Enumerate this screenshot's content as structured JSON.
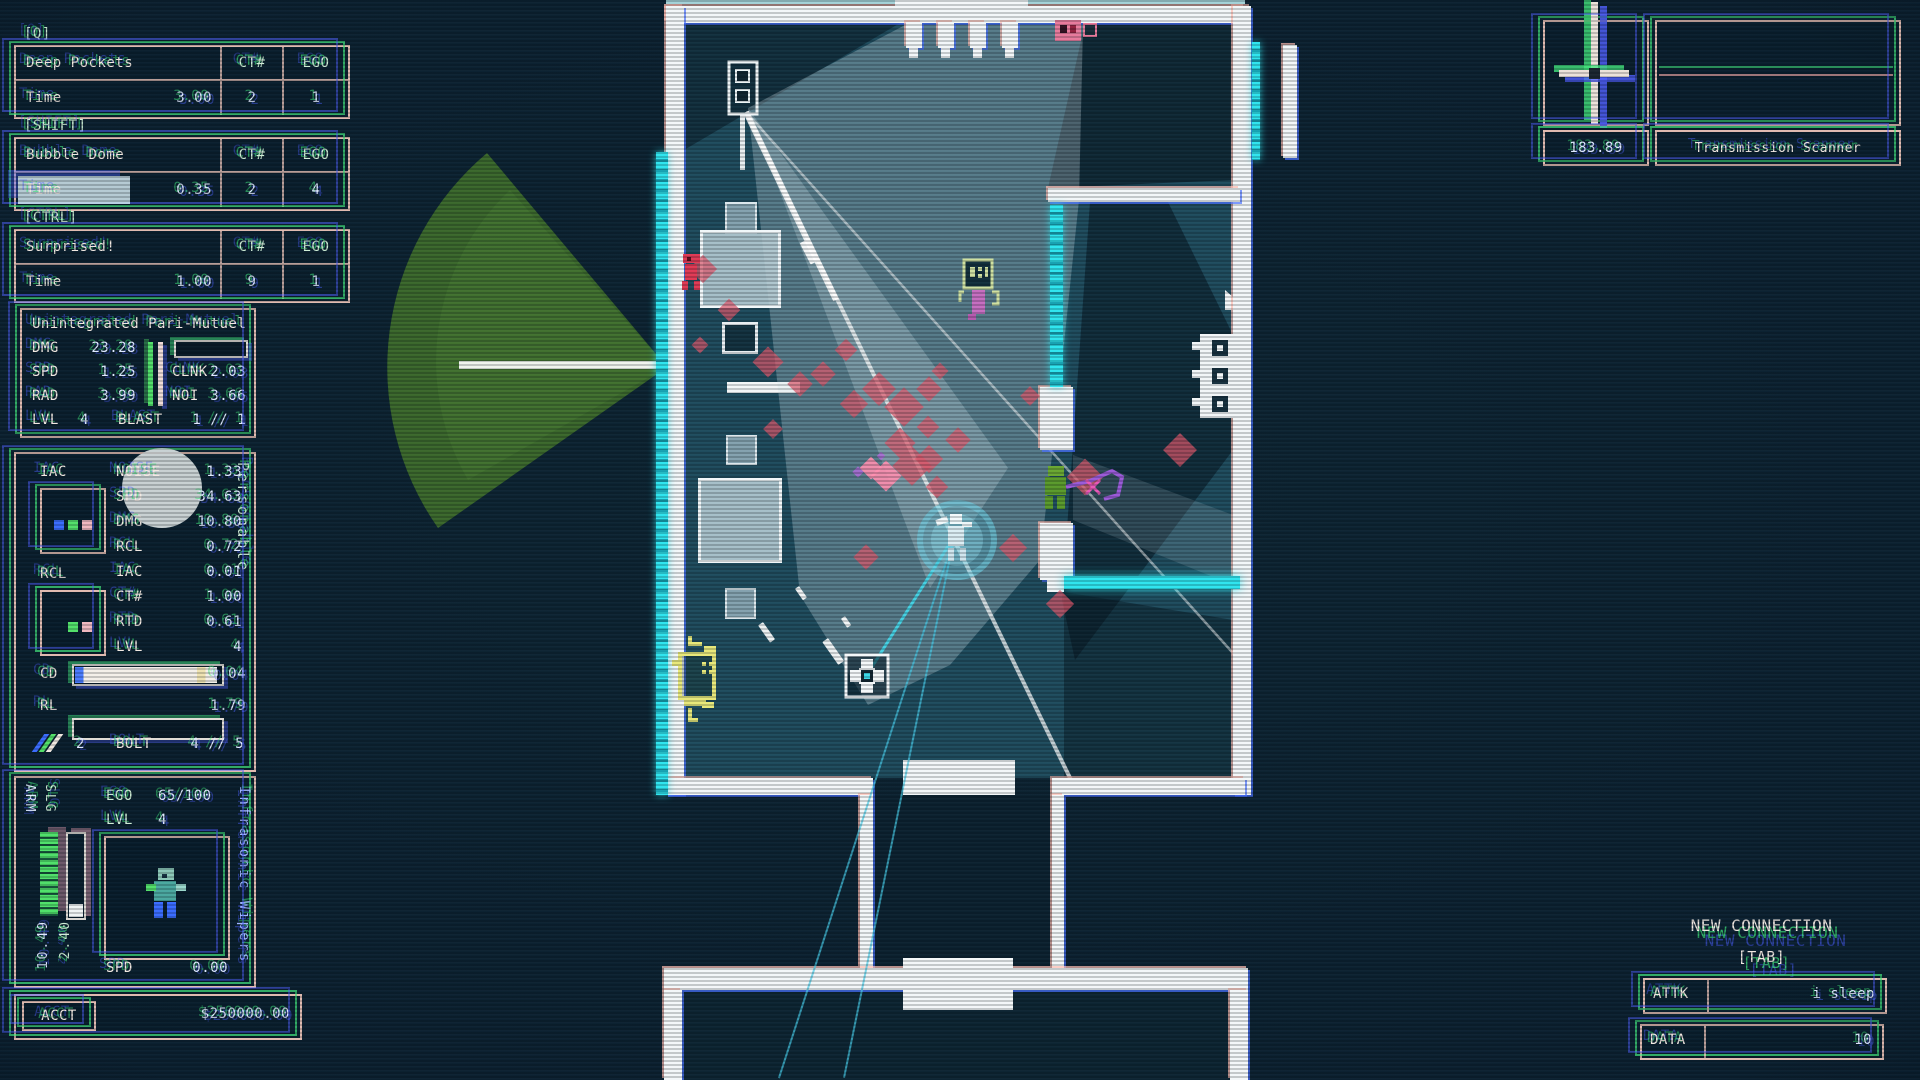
{
  "colors": {
    "cyan": "#2fe5ef",
    "red_diamond": "#d9566a",
    "bright_pink": "#ff8fb0",
    "purple": "#a96bd4",
    "green_zone": "#3f6f2b",
    "hud_green": "#46e07c",
    "hud_blue": "#4a5cff",
    "hud_pink": "#f2c8bc"
  },
  "hud": {
    "ability_headers": {
      "ct": "CT#",
      "ego": "EGO"
    },
    "abilities": [
      {
        "hotkey": "[Q]",
        "name": "Deep Pockets",
        "stat_label": "Time",
        "stat_value": "3.00",
        "ct": "2",
        "ego": "1",
        "progress": 0
      },
      {
        "hotkey": "[SHIFT]",
        "name": "Bubble Dome",
        "stat_label": "Time",
        "stat_value": "0.35",
        "ct": "2",
        "ego": "4",
        "progress": 55
      },
      {
        "hotkey": "[CTRL]",
        "name": "Surprised!",
        "stat_label": "Time",
        "stat_value": "1.00",
        "ct": "9",
        "ego": "1",
        "progress": 0
      }
    ],
    "weapon": {
      "name": "Unintegrated Pari-Mutuel",
      "stats_left": [
        [
          "DMG",
          "23.28"
        ],
        [
          "SPD",
          "1.25"
        ],
        [
          "RAD",
          "3.99"
        ]
      ],
      "clnk_label": "CLNK",
      "clnk_value": "2.03",
      "noi_label": "NOI",
      "noi_value": "3.66",
      "lvl_label": "LVL",
      "lvl_value": "4",
      "blast_label": "BLAST",
      "blast_value": "1 // 1"
    },
    "secondary": {
      "title": "Personable",
      "slot1_label": "IAC",
      "slot2_label": "RCL",
      "stats": [
        [
          "NOISE",
          "1.33"
        ],
        [
          "SPD",
          "34.63"
        ],
        [
          "DMG",
          "10.80"
        ],
        [
          "RCL",
          "0.72"
        ],
        [
          "IAC",
          "0.01"
        ],
        [
          "CT#",
          "1.00"
        ],
        [
          "RTD",
          "0.61"
        ],
        [
          "LVL",
          "4"
        ]
      ],
      "cd_label": "CD",
      "cd_value": "0.04",
      "rl_label": "RL",
      "rl_value": "1.79",
      "ammo_count": "2",
      "bolt_label": "BOLT",
      "bolt_value": "4 // 5"
    },
    "character": {
      "name": "Infrasonic Wipers",
      "ego_label": "EGO",
      "ego_value": "65/100",
      "lvl_label": "LVL",
      "lvl_value": "4",
      "slg_label": "SLG",
      "arm_label": "ARM",
      "slg_value": "2.40",
      "arm_value": "10.49",
      "spd_label": "SPD",
      "spd_value": "0.00",
      "acct_label": "ACCT",
      "acct_value": "$250000.00"
    },
    "scanner": {
      "reading": "183.89",
      "name": "Transmission Scanner"
    },
    "connection": {
      "title": "NEW CONNECTION",
      "key": "[TAB]",
      "attk_label": "ATTK",
      "attk_value": "i sleep",
      "data_label": "DATA",
      "data_value": "10"
    }
  },
  "map": {
    "player": {
      "x": 955,
      "y": 538
    },
    "aim_lines": [
      {
        "x2": 868,
        "y2": 676,
        "w": 2.5,
        "c": "rgba(69,214,232,.95)"
      },
      {
        "x2": 780,
        "y2": 1078,
        "w": 1.5,
        "c": "rgba(70,200,228,.70)"
      },
      {
        "x2": 845,
        "y2": 1078,
        "w": 1.5,
        "c": "rgba(70,200,228,.70)"
      }
    ],
    "dashes": [
      {
        "x": 763,
        "y": 622,
        "l": 21,
        "w": 6,
        "a": 55
      },
      {
        "x": 828,
        "y": 638,
        "l": 28,
        "w": 7,
        "a": 55
      },
      {
        "x": 845,
        "y": 616,
        "l": 11,
        "w": 5,
        "a": 55
      },
      {
        "x": 799,
        "y": 586,
        "l": 14,
        "w": 5,
        "a": 55
      },
      {
        "x": 806,
        "y": 240,
        "l": 24,
        "w": 7,
        "a": 63
      }
    ],
    "crates": [
      {
        "x": 725,
        "y": 202,
        "w": 28,
        "h": 28,
        "v": "light"
      },
      {
        "x": 700,
        "y": 230,
        "w": 75,
        "h": 72,
        "v": "lit"
      },
      {
        "x": 722,
        "y": 322,
        "w": 30,
        "h": 26,
        "v": "dark"
      },
      {
        "x": 726,
        "y": 435,
        "w": 27,
        "h": 26,
        "v": "light"
      },
      {
        "x": 698,
        "y": 478,
        "w": 78,
        "h": 79,
        "v": "lit"
      },
      {
        "x": 725,
        "y": 588,
        "w": 27,
        "h": 27,
        "v": "light"
      }
    ],
    "diamonds": [
      {
        "x": 703,
        "y": 269,
        "s": 20,
        "c": "red"
      },
      {
        "x": 729,
        "y": 310,
        "s": 16,
        "c": "red"
      },
      {
        "x": 700,
        "y": 345,
        "s": 12,
        "c": "red"
      },
      {
        "x": 768,
        "y": 362,
        "s": 22,
        "c": "red"
      },
      {
        "x": 800,
        "y": 384,
        "s": 18,
        "c": "red"
      },
      {
        "x": 846,
        "y": 350,
        "s": 16,
        "c": "red"
      },
      {
        "x": 879,
        "y": 389,
        "s": 24,
        "c": "red"
      },
      {
        "x": 904,
        "y": 407,
        "s": 28,
        "c": "red"
      },
      {
        "x": 929,
        "y": 389,
        "s": 18,
        "c": "red"
      },
      {
        "x": 940,
        "y": 371,
        "s": 12,
        "c": "red"
      },
      {
        "x": 823,
        "y": 374,
        "s": 18,
        "c": "red"
      },
      {
        "x": 854,
        "y": 404,
        "s": 20,
        "c": "red"
      },
      {
        "x": 900,
        "y": 443,
        "s": 22,
        "c": "red"
      },
      {
        "x": 928,
        "y": 427,
        "s": 16,
        "c": "red"
      },
      {
        "x": 773,
        "y": 429,
        "s": 14,
        "c": "red"
      },
      {
        "x": 929,
        "y": 459,
        "s": 20,
        "c": "red"
      },
      {
        "x": 886,
        "y": 476,
        "s": 22,
        "c": "bright"
      },
      {
        "x": 871,
        "y": 468,
        "s": 16,
        "c": "bright"
      },
      {
        "x": 912,
        "y": 466,
        "s": 28,
        "c": "red"
      },
      {
        "x": 958,
        "y": 440,
        "s": 18,
        "c": "red"
      },
      {
        "x": 937,
        "y": 487,
        "s": 16,
        "c": "red"
      },
      {
        "x": 1013,
        "y": 548,
        "s": 20,
        "c": "red"
      },
      {
        "x": 1060,
        "y": 604,
        "s": 20,
        "c": "red"
      },
      {
        "x": 1085,
        "y": 477,
        "s": 26,
        "c": "red"
      },
      {
        "x": 1180,
        "y": 450,
        "s": 24,
        "c": "red"
      },
      {
        "x": 866,
        "y": 557,
        "s": 18,
        "c": "red"
      },
      {
        "x": 1030,
        "y": 396,
        "s": 14,
        "c": "red"
      },
      {
        "x": 858,
        "y": 472,
        "s": 8,
        "c": "purple"
      },
      {
        "x": 881,
        "y": 456,
        "s": 6,
        "c": "purple"
      }
    ]
  }
}
